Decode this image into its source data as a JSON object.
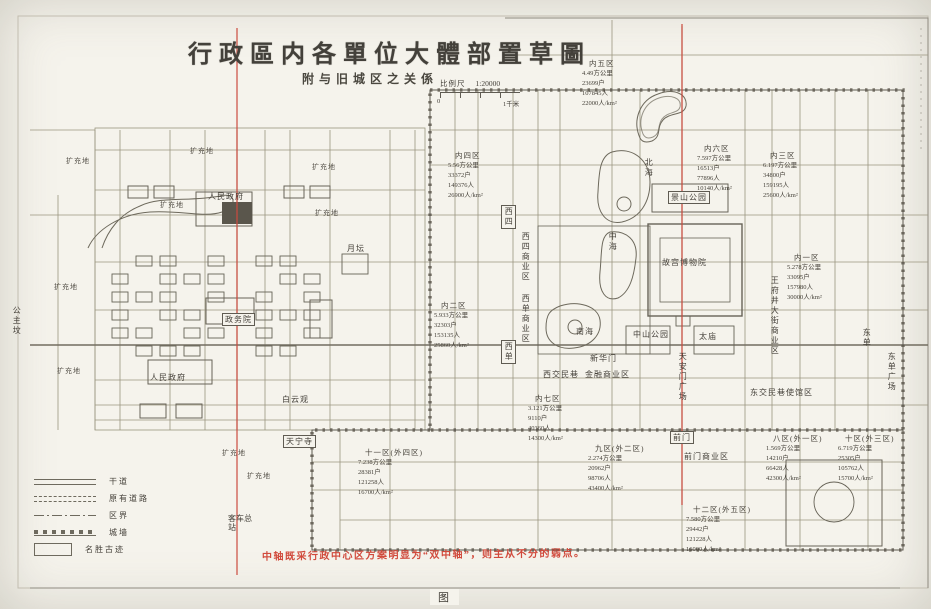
{
  "page": {
    "title": "行政區内各單位大體部置草圖",
    "subtitle": "附与旧城区之关係",
    "caption": "图"
  },
  "scale": {
    "label": "比例尺",
    "ratio": "1:20000",
    "zero": "0",
    "unit": "1千米"
  },
  "annotation": {
    "red_note": "中轴既采行政中心区方案明显为“双中轴”，则主从不分的弱点。"
  },
  "legend": {
    "items": [
      {
        "type": "trunk",
        "label": "干道"
      },
      {
        "type": "existing",
        "label": "原有道路"
      },
      {
        "type": "boundary",
        "label": "区界"
      },
      {
        "type": "wall",
        "label": "城墙"
      },
      {
        "type": "monument",
        "label": "名胜古迹"
      }
    ]
  },
  "map": {
    "districts": [
      {
        "name": "内五区",
        "area": "4.49方公里",
        "households": "23699户",
        "population": "107845人",
        "density": "22000人/km²",
        "x": 582,
        "y": 58
      },
      {
        "name": "内四区",
        "area": "5.56方公里",
        "households": "33372户",
        "population": "149376人",
        "density": "26900人/km²",
        "x": 448,
        "y": 150
      },
      {
        "name": "内六区",
        "area": "7.597方公里",
        "households": "16513户",
        "population": "77896人",
        "density": "10140人/km²",
        "x": 697,
        "y": 143
      },
      {
        "name": "内三区",
        "area": "6.197方公里",
        "households": "34800户",
        "population": "159195人",
        "density": "25600人/km²",
        "x": 763,
        "y": 150
      },
      {
        "name": "内一区",
        "area": "5.278方公里",
        "households": "33095户",
        "population": "157980人",
        "density": "30000人/km²",
        "x": 787,
        "y": 252
      },
      {
        "name": "内二区",
        "area": "5.933方公里",
        "households": "32303户",
        "population": "153135人",
        "density": "25860人/km²",
        "x": 434,
        "y": 300
      },
      {
        "name": "内七区",
        "area": "3.121方公里",
        "households": "9110户",
        "population": "40360人",
        "density": "14300人/km²",
        "x": 528,
        "y": 393
      },
      {
        "name": "十一区(外四区)",
        "area": "7.238方公里",
        "households": "28381户",
        "population": "121258人",
        "density": "16700人/km²",
        "x": 358,
        "y": 447
      },
      {
        "name": "九区(外二区)",
        "area": "2.274方公里",
        "households": "20962户",
        "population": "98706人",
        "density": "43400人/km²",
        "x": 588,
        "y": 443
      },
      {
        "name": "八区(外一区)",
        "area": "1.569方公里",
        "households": "14210户",
        "population": "66428人",
        "density": "42300人/km²",
        "x": 766,
        "y": 433
      },
      {
        "name": "十区(外三区)",
        "area": "6.719方公里",
        "households": "25305户",
        "population": "105762人",
        "density": "15700人/km²",
        "x": 838,
        "y": 433
      },
      {
        "name": "十二区(外五区)",
        "area": "7.580方公里",
        "households": "29442户",
        "population": "121228人",
        "density": "16000人/km²",
        "x": 686,
        "y": 504
      }
    ],
    "places": [
      {
        "label": "北海",
        "o": "v",
        "x": 644,
        "y": 158
      },
      {
        "label": "中海",
        "o": "v",
        "x": 608,
        "y": 232
      },
      {
        "label": "南海",
        "o": "h",
        "x": 576,
        "y": 327
      },
      {
        "label": "景山公园",
        "o": "h",
        "x": 668,
        "y": 191,
        "boxed": true
      },
      {
        "label": "故宫博物院",
        "o": "h",
        "x": 662,
        "y": 258
      },
      {
        "label": "中山公园",
        "o": "h",
        "x": 633,
        "y": 330
      },
      {
        "label": "太庙",
        "o": "h",
        "x": 699,
        "y": 332
      },
      {
        "label": "新华门",
        "o": "h",
        "x": 590,
        "y": 354
      },
      {
        "label": "天安门广场",
        "o": "v",
        "x": 678,
        "y": 352
      },
      {
        "label": "前门",
        "o": "h",
        "x": 670,
        "y": 431,
        "boxed": true
      },
      {
        "label": "前门商业区",
        "o": "h",
        "x": 684,
        "y": 452
      },
      {
        "label": "西四",
        "o": "v",
        "x": 501,
        "y": 205,
        "boxed": true
      },
      {
        "label": "西四商业区",
        "o": "v",
        "x": 521,
        "y": 232
      },
      {
        "label": "西单商业区",
        "o": "v",
        "x": 521,
        "y": 294
      },
      {
        "label": "西单",
        "o": "v",
        "x": 501,
        "y": 340,
        "boxed": true
      },
      {
        "label": "西交民巷",
        "o": "h",
        "x": 543,
        "y": 370
      },
      {
        "label": "金融商业区",
        "o": "h",
        "x": 585,
        "y": 370
      },
      {
        "label": "月坛",
        "o": "h",
        "x": 347,
        "y": 244
      },
      {
        "label": "公主坟",
        "o": "v",
        "x": 12,
        "y": 306
      },
      {
        "label": "东单",
        "o": "v",
        "x": 862,
        "y": 328
      },
      {
        "label": "东单广场",
        "o": "v",
        "x": 887,
        "y": 352
      },
      {
        "label": "东交民巷使馆区",
        "o": "h",
        "x": 750,
        "y": 388
      },
      {
        "label": "王府井大街商业区",
        "o": "v",
        "x": 770,
        "y": 276
      },
      {
        "label": "人民政府",
        "o": "h",
        "x": 208,
        "y": 192
      },
      {
        "label": "政务院",
        "o": "h",
        "x": 222,
        "y": 313,
        "boxed": true
      },
      {
        "label": "人民政府",
        "o": "h",
        "x": 150,
        "y": 373
      },
      {
        "label": "白云观",
        "o": "h",
        "x": 282,
        "y": 395
      },
      {
        "label": "天宁寺",
        "o": "h",
        "x": 283,
        "y": 435,
        "boxed": true
      },
      {
        "label": "客车总站",
        "o": "ml",
        "x": 228,
        "y": 514
      }
    ],
    "expansion": {
      "text": "扩充地",
      "positions": [
        [
          66,
          156
        ],
        [
          190,
          146
        ],
        [
          312,
          162
        ],
        [
          160,
          200
        ],
        [
          315,
          208
        ],
        [
          54,
          282
        ],
        [
          57,
          366
        ],
        [
          222,
          448
        ],
        [
          247,
          471
        ]
      ]
    }
  },
  "colors": {
    "paper": "#f5f3ec",
    "ink": "#45413a",
    "red_axis": "#cc4b3e",
    "red_note": "#d14a3c"
  }
}
